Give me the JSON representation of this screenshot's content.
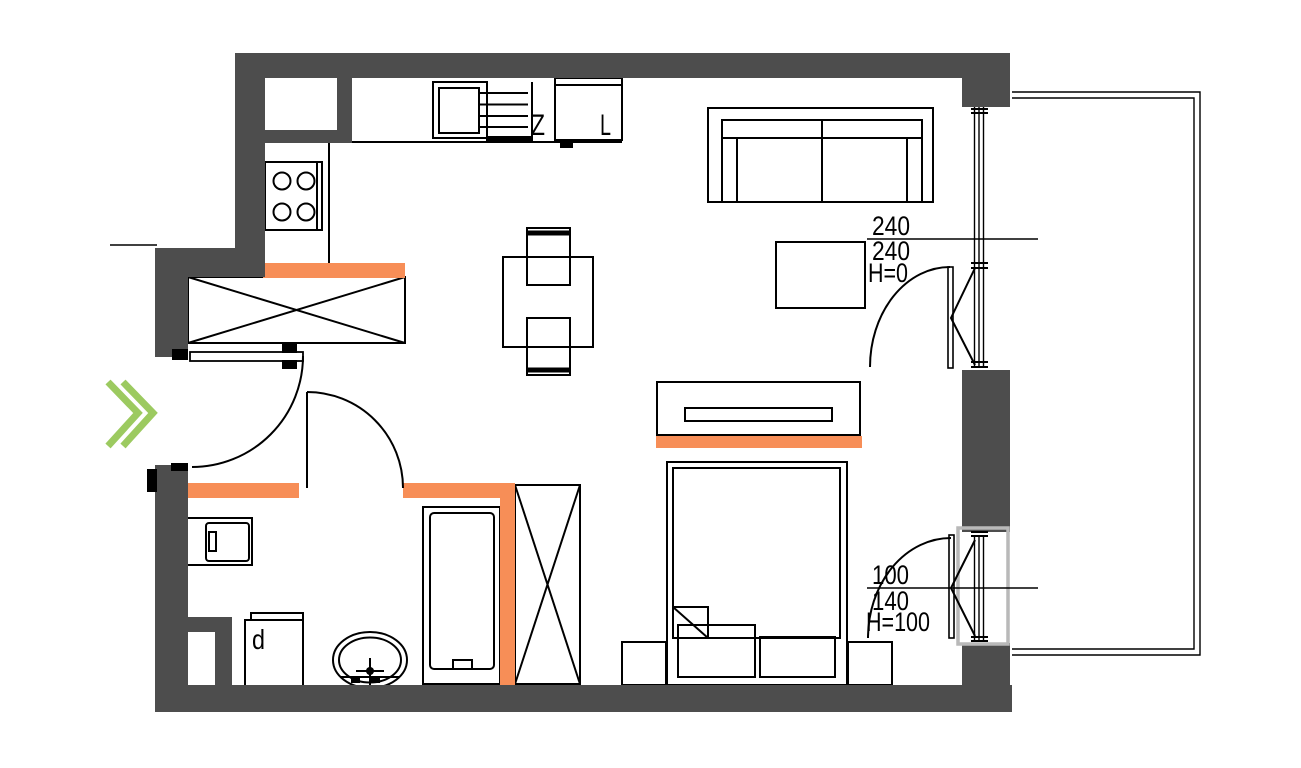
{
  "colors": {
    "background": "#ffffff",
    "wall": "#4d4d4d",
    "line": "#000000",
    "accent_orange": "#f78e57",
    "entry_green": "#9cca60",
    "window_frame_gray": "#b9b9b9"
  },
  "plan": {
    "kitchen": {
      "sink_label": "Z",
      "fridge_label": "L"
    },
    "bathroom": {
      "cabinet_label": "d"
    },
    "openings": {
      "balcony_door": {
        "dim_top": "240",
        "dim_bottom": "240",
        "sill": "H=0"
      },
      "bedroom_window": {
        "dim_top": "100",
        "dim_bottom": "140",
        "sill": "H=100"
      }
    }
  }
}
